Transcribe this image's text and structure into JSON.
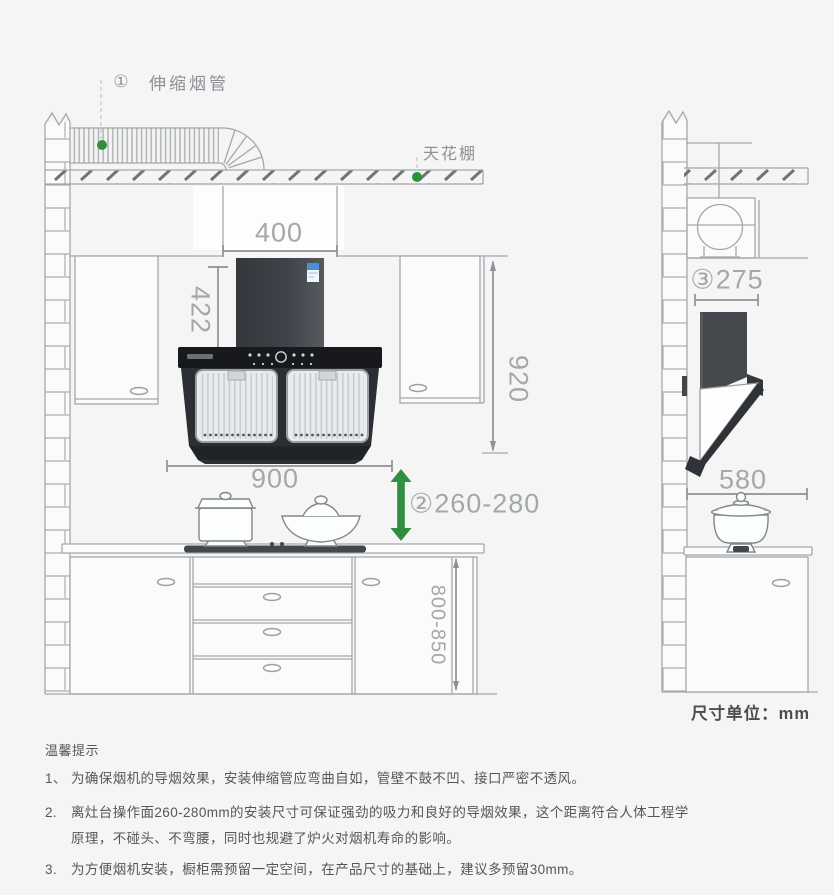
{
  "page": {
    "background": "#f5f5f6"
  },
  "colors": {
    "accent_green": "#2f8f3e",
    "line_gray": "#a4a8ab",
    "dim_line": "#8d9296",
    "dim_text": "#a3a8ab",
    "label_text": "#8c9094",
    "hood_dark": "#2b2f33",
    "energy_label_blue": "#4a90d9",
    "note_text": "#54575a",
    "unit_text": "#4a4e51"
  },
  "callouts": {
    "pipe_num": "①",
    "pipe_label": "伸缩烟管",
    "ceiling_label": "天花棚"
  },
  "dimensions": {
    "flue_zone_width": "400",
    "chimney_height": "422",
    "upper_section_height": "920",
    "hood_width": "900",
    "hood_to_cooktop_num": "②",
    "hood_to_cooktop_range": "260-280",
    "outlet_depth_num": "③",
    "outlet_depth": "275",
    "hood_depth": "580",
    "base_cabinet_height": "800-850"
  },
  "unit_note": "尺寸单位：mm",
  "tips": {
    "title": "温馨提示",
    "items": [
      {
        "num": "1、",
        "lines": [
          "为确保烟机的导烟效果，安装伸缩管应弯曲自如，管壁不鼓不凹、接口严密不透风。"
        ]
      },
      {
        "num": "2.",
        "lines": [
          "离灶台操作面260-280mm的安装尺寸可保证强劲的吸力和良好的导烟效果，这个距离符合人体工程学",
          "原理，不碰头、不弯腰，同时也规避了炉火对烟机寿命的影响。"
        ]
      },
      {
        "num": "3.",
        "lines": [
          "为方便烟机安装，橱柜需预留一定空间，在产品尺寸的基础上，建议多预留30mm。"
        ]
      }
    ]
  }
}
